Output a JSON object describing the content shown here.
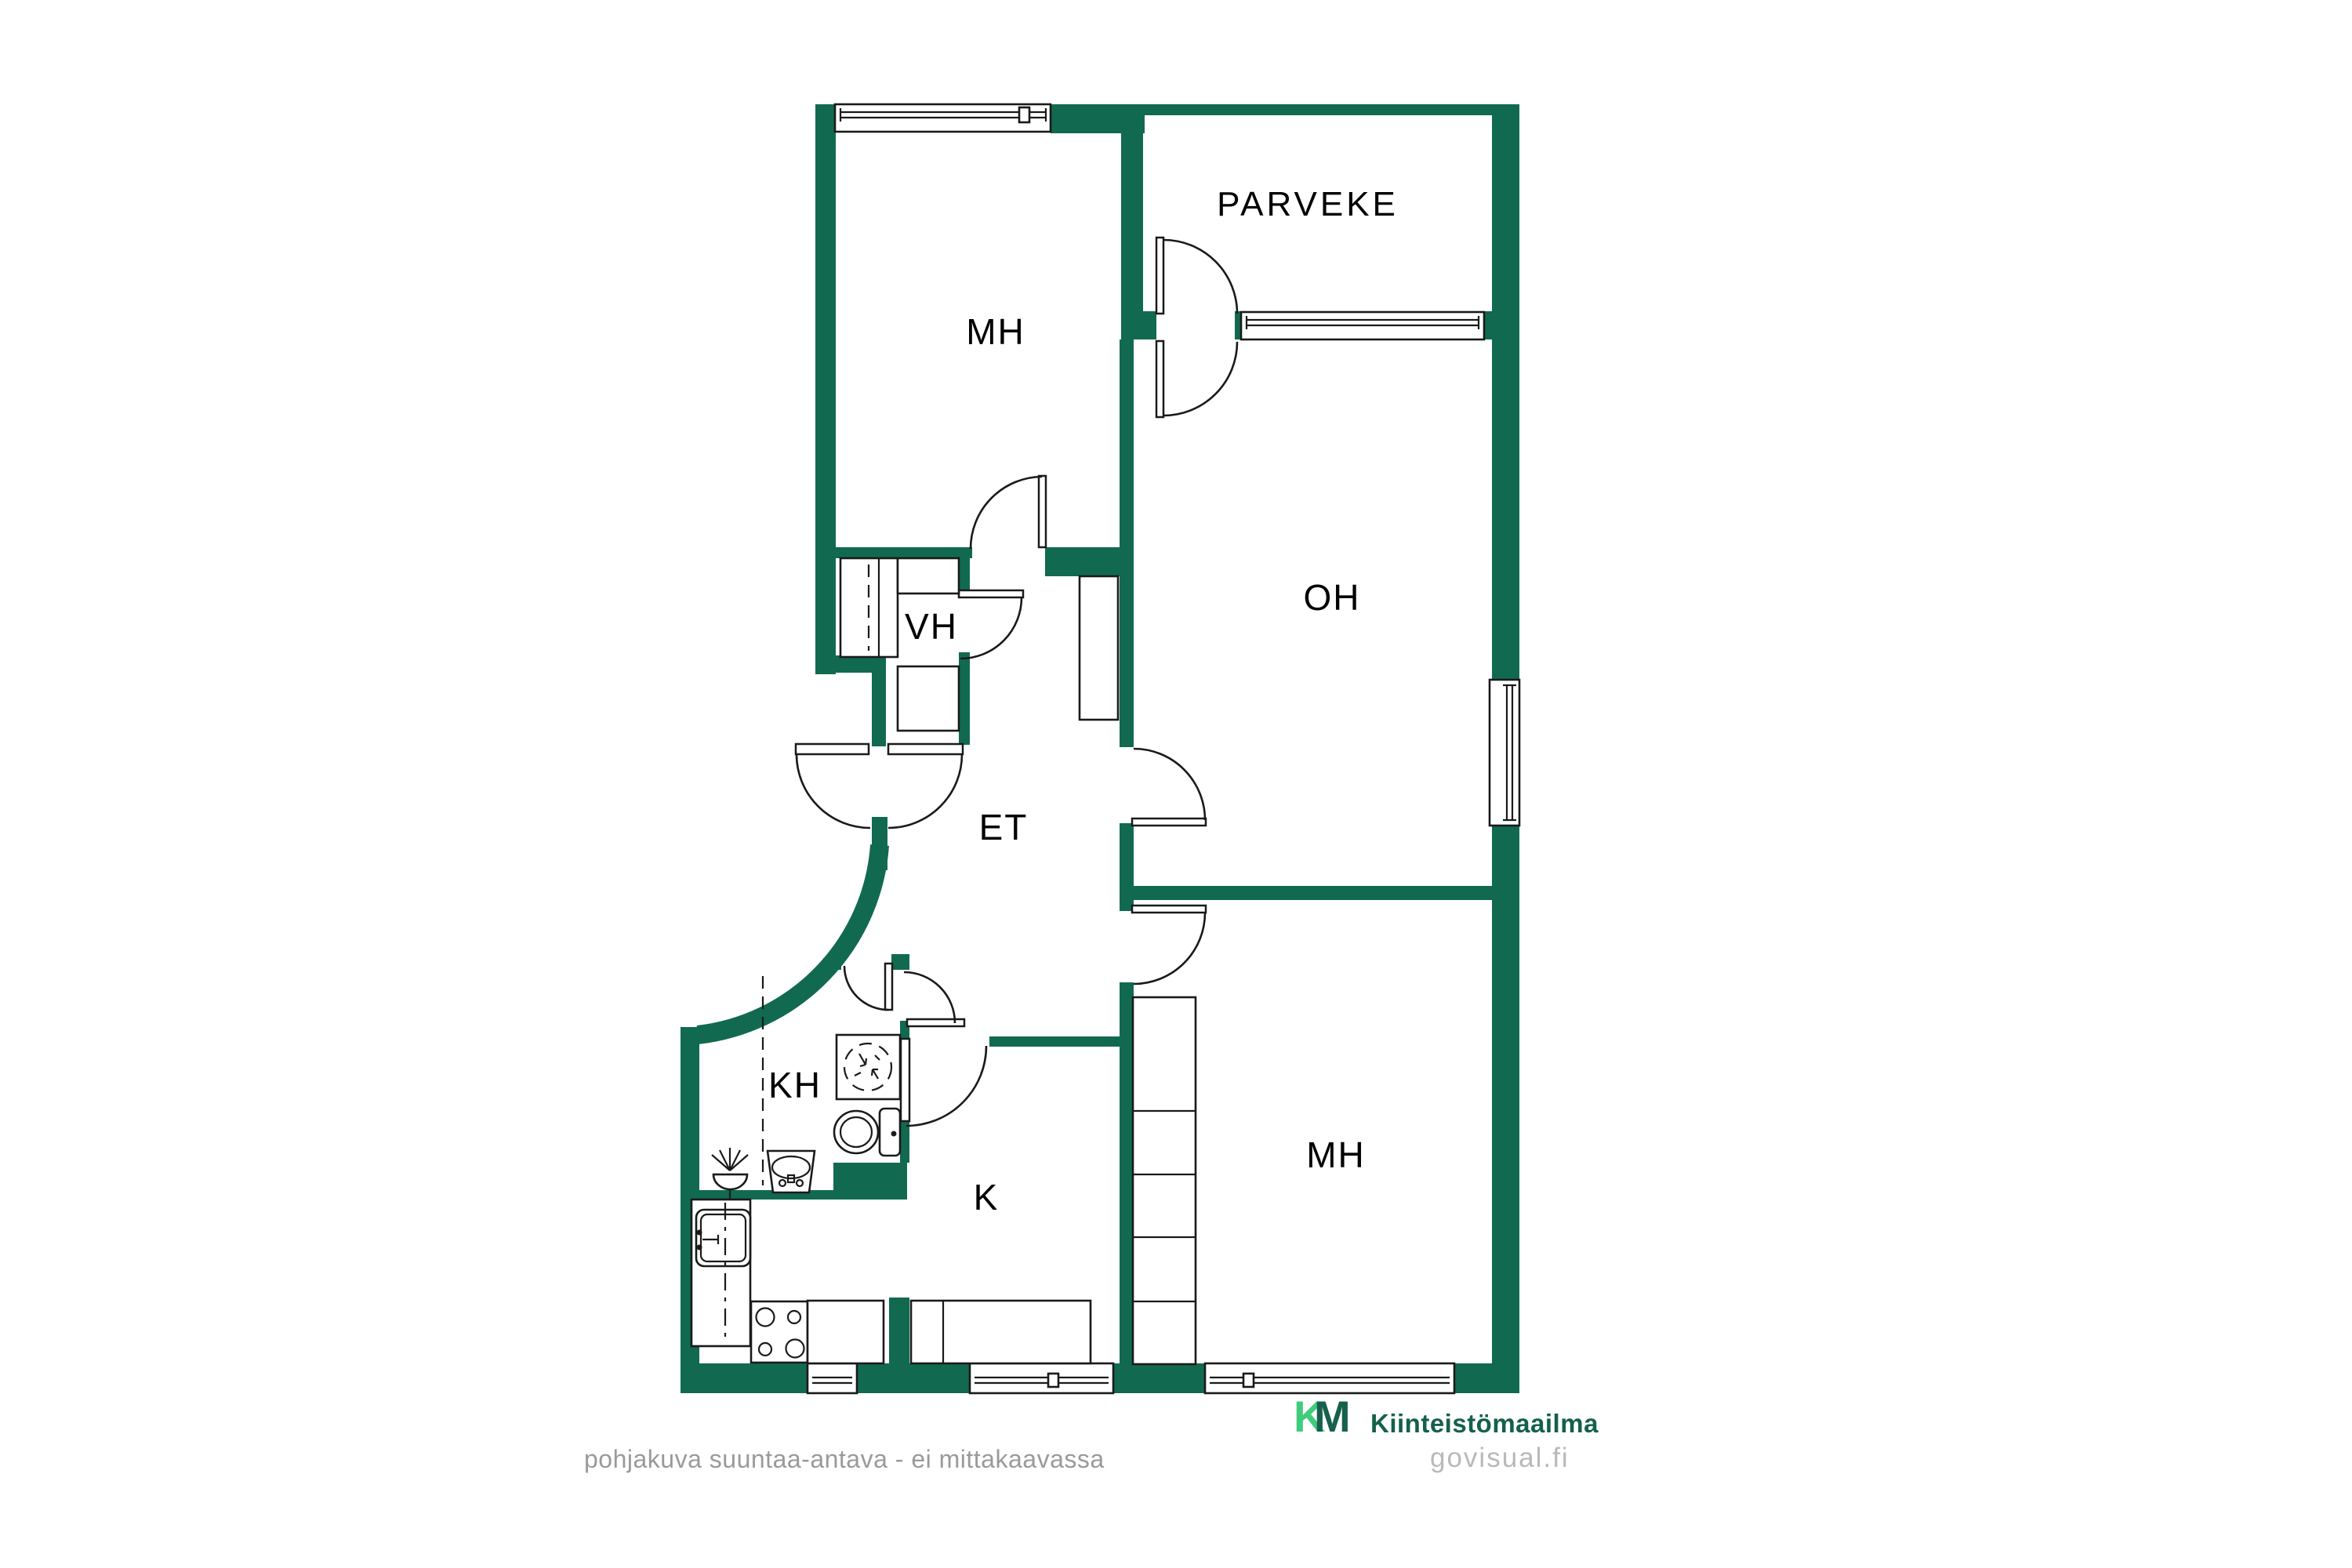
{
  "floorplan": {
    "wall_color": "#116a50",
    "line_color": "#1a1a1a",
    "rooms": [
      {
        "id": "mh-top",
        "label": "MH"
      },
      {
        "id": "parveke",
        "label": "PARVEKE"
      },
      {
        "id": "oh",
        "label": "OH"
      },
      {
        "id": "vh",
        "label": "VH"
      },
      {
        "id": "et",
        "label": "ET"
      },
      {
        "id": "kh",
        "label": "KH"
      },
      {
        "id": "k",
        "label": "K"
      },
      {
        "id": "mh-bottom",
        "label": "MH"
      }
    ]
  },
  "footer": {
    "disclaimer": "pohjakuva suuntaa-antava - ei mittakaavassa"
  },
  "branding": {
    "logo_k": "K",
    "logo_m": "M",
    "company": "Kiinteistömaailma",
    "watermark": "govisual.fi",
    "logo_green_light": "#3fcc7c",
    "logo_green_dark": "#17604c"
  }
}
